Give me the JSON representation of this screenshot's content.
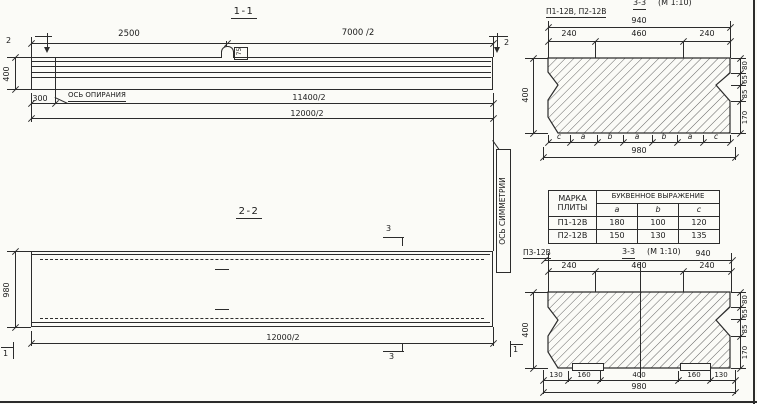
{
  "s11": {
    "title": "1-1",
    "dim_2500": "2500",
    "dim_7000": "7000 /2",
    "dim_400": "400",
    "dim_300": "300",
    "bearing_axis": "ОСЬ ОПИРАНИЯ",
    "dim_11400": "11400/2",
    "dim_12000": "12000/2",
    "loop_tag": "75",
    "cut2": "2"
  },
  "s22": {
    "title": "2-2",
    "dim_980": "980",
    "dim_12000": "12000/2",
    "cut3": "3",
    "cut1": "1",
    "symmetry_axis": "ОСЬ СИММЕТРИИ"
  },
  "s33a": {
    "plates": "П1-12В, П2-12В",
    "title": "3-3",
    "scale": "(М 1:10)",
    "dim_940": "940",
    "dim_240l": "240",
    "dim_460": "460",
    "dim_240r": "240",
    "dim_400": "400",
    "r80": "80",
    "r65": "65",
    "r85": "85",
    "r170": "170",
    "letters": [
      "c",
      "a",
      "b",
      "a",
      "b",
      "a",
      "c"
    ],
    "dim_980": "980"
  },
  "table": {
    "h_mark": "МАРКА\nПЛИТЫ",
    "h_expr": "БУКВЕННОЕ  ВЫРАЖЕНИЕ",
    "col_a": "a",
    "col_b": "b",
    "col_c": "c",
    "rows": [
      {
        "mark": "П1-12В",
        "a": "180",
        "b": "100",
        "c": "120"
      },
      {
        "mark": "П2-12В",
        "a": "150",
        "b": "130",
        "c": "135"
      }
    ]
  },
  "s33b": {
    "plate": "П3-12В",
    "title": "3-3",
    "scale": "(М 1:10)",
    "dim_940": "940",
    "dim_240l": "240",
    "dim_460": "460",
    "dim_240r": "240",
    "dim_400": "400",
    "r80": "80",
    "r65": "65",
    "r85": "85",
    "r170": "170",
    "b130l": "130",
    "b160l": "160",
    "b400": "400",
    "b160r": "160",
    "b130r": "130",
    "dim_980": "980"
  }
}
